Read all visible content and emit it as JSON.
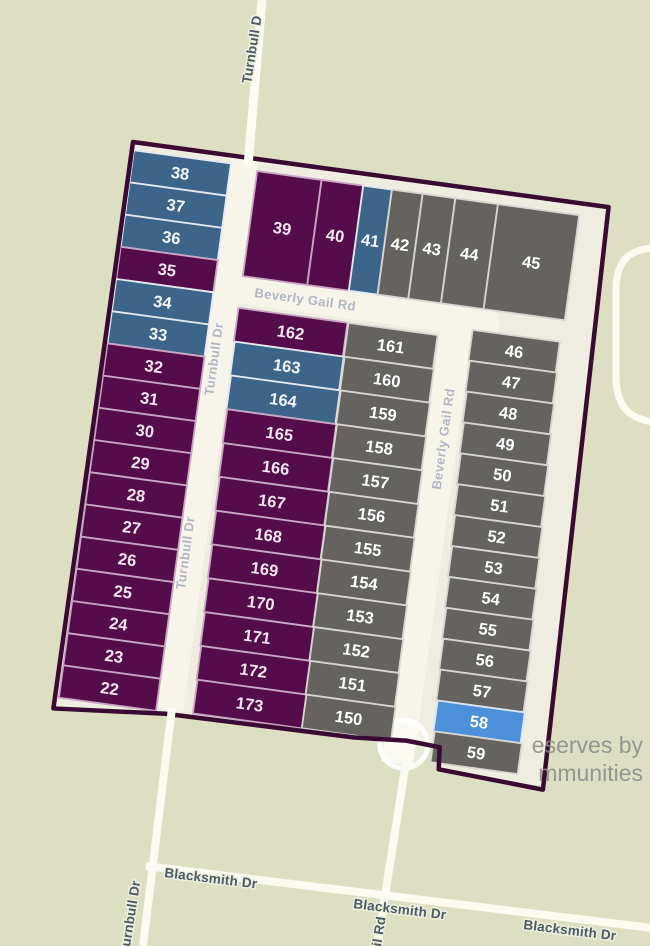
{
  "map": {
    "watermark": {
      "line1": "eserves by",
      "line2": "mmunities"
    },
    "streets": {
      "turnbull_top": "Turnbull D",
      "turnbull_inner": "Turnbull Dr",
      "turnbull_bottom": "urnbull Dr",
      "beverly_horizontal": "Beverly Gail Rd",
      "beverly_vertical": "Beverly Gail Rd",
      "beverly_bottom": "il Rd",
      "blacksmith": "Blacksmith Dr"
    },
    "colors": {
      "background": "#dcdfc2",
      "subdivision_interior": "#efede0",
      "road": "#fcfbf2",
      "boundary": "#3a0a33",
      "inner_street_label": "#acb1c5",
      "outer_street_label": "#4b5a66",
      "watermark": "#8c8c8c"
    },
    "palette": {
      "purple": {
        "fill": "#540d4a",
        "stroke": "#c9a5c4",
        "text": "#f3e6f0"
      },
      "blue": {
        "fill": "#3d6589",
        "stroke": "#e3e9ef",
        "text": "#f4f8fb"
      },
      "gray": {
        "fill": "#646360",
        "stroke": "#d7d6d3",
        "text": "#ffffff"
      },
      "lightblue": {
        "fill": "#4b90d9",
        "stroke": "#d9e5f2",
        "text": "#ffffff"
      }
    },
    "lot_groups": [
      {
        "key": "west",
        "name": "west-column",
        "lots": [
          {
            "label": "38",
            "color": "blue"
          },
          {
            "label": "37",
            "color": "blue"
          },
          {
            "label": "36",
            "color": "blue"
          },
          {
            "label": "35",
            "color": "purple"
          },
          {
            "label": "34",
            "color": "blue"
          },
          {
            "label": "33",
            "color": "blue"
          },
          {
            "label": "32",
            "color": "purple"
          },
          {
            "label": "31",
            "color": "purple"
          },
          {
            "label": "30",
            "color": "purple"
          },
          {
            "label": "29",
            "color": "purple"
          },
          {
            "label": "28",
            "color": "purple"
          },
          {
            "label": "27",
            "color": "purple"
          },
          {
            "label": "26",
            "color": "purple"
          },
          {
            "label": "25",
            "color": "purple"
          },
          {
            "label": "24",
            "color": "purple"
          },
          {
            "label": "23",
            "color": "purple"
          },
          {
            "label": "22",
            "color": "purple"
          }
        ]
      },
      {
        "key": "north",
        "name": "north-row",
        "lots": [
          {
            "label": "39",
            "color": "purple"
          },
          {
            "label": "40",
            "color": "purple"
          },
          {
            "label": "41",
            "color": "blue"
          },
          {
            "label": "42",
            "color": "gray"
          },
          {
            "label": "43",
            "color": "gray"
          },
          {
            "label": "44",
            "color": "gray"
          },
          {
            "label": "45",
            "color": "gray"
          }
        ]
      },
      {
        "key": "mid",
        "name": "middle-column",
        "lots": [
          {
            "label": "162",
            "color": "purple"
          },
          {
            "label": "163",
            "color": "blue"
          },
          {
            "label": "164",
            "color": "blue"
          },
          {
            "label": "165",
            "color": "purple"
          },
          {
            "label": "166",
            "color": "purple"
          },
          {
            "label": "167",
            "color": "purple"
          },
          {
            "label": "168",
            "color": "purple"
          },
          {
            "label": "169",
            "color": "purple"
          },
          {
            "label": "170",
            "color": "purple"
          },
          {
            "label": "171",
            "color": "purple"
          },
          {
            "label": "172",
            "color": "purple"
          },
          {
            "label": "173",
            "color": "purple"
          }
        ]
      },
      {
        "key": "center",
        "name": "center-column",
        "lots": [
          {
            "label": "161",
            "color": "gray"
          },
          {
            "label": "160",
            "color": "gray"
          },
          {
            "label": "159",
            "color": "gray"
          },
          {
            "label": "158",
            "color": "gray"
          },
          {
            "label": "157",
            "color": "gray"
          },
          {
            "label": "156",
            "color": "gray"
          },
          {
            "label": "155",
            "color": "gray"
          },
          {
            "label": "154",
            "color": "gray"
          },
          {
            "label": "153",
            "color": "gray"
          },
          {
            "label": "152",
            "color": "gray"
          },
          {
            "label": "151",
            "color": "gray"
          },
          {
            "label": "150",
            "color": "gray"
          }
        ]
      },
      {
        "key": "east",
        "name": "east-column",
        "lots": [
          {
            "label": "46",
            "color": "gray"
          },
          {
            "label": "47",
            "color": "gray"
          },
          {
            "label": "48",
            "color": "gray"
          },
          {
            "label": "49",
            "color": "gray"
          },
          {
            "label": "50",
            "color": "gray"
          },
          {
            "label": "51",
            "color": "gray"
          },
          {
            "label": "52",
            "color": "gray"
          },
          {
            "label": "53",
            "color": "gray"
          },
          {
            "label": "54",
            "color": "gray"
          },
          {
            "label": "55",
            "color": "gray"
          },
          {
            "label": "56",
            "color": "gray"
          },
          {
            "label": "57",
            "color": "gray"
          },
          {
            "label": "58",
            "color": "lightblue"
          },
          {
            "label": "59",
            "color": "gray"
          }
        ]
      }
    ]
  }
}
